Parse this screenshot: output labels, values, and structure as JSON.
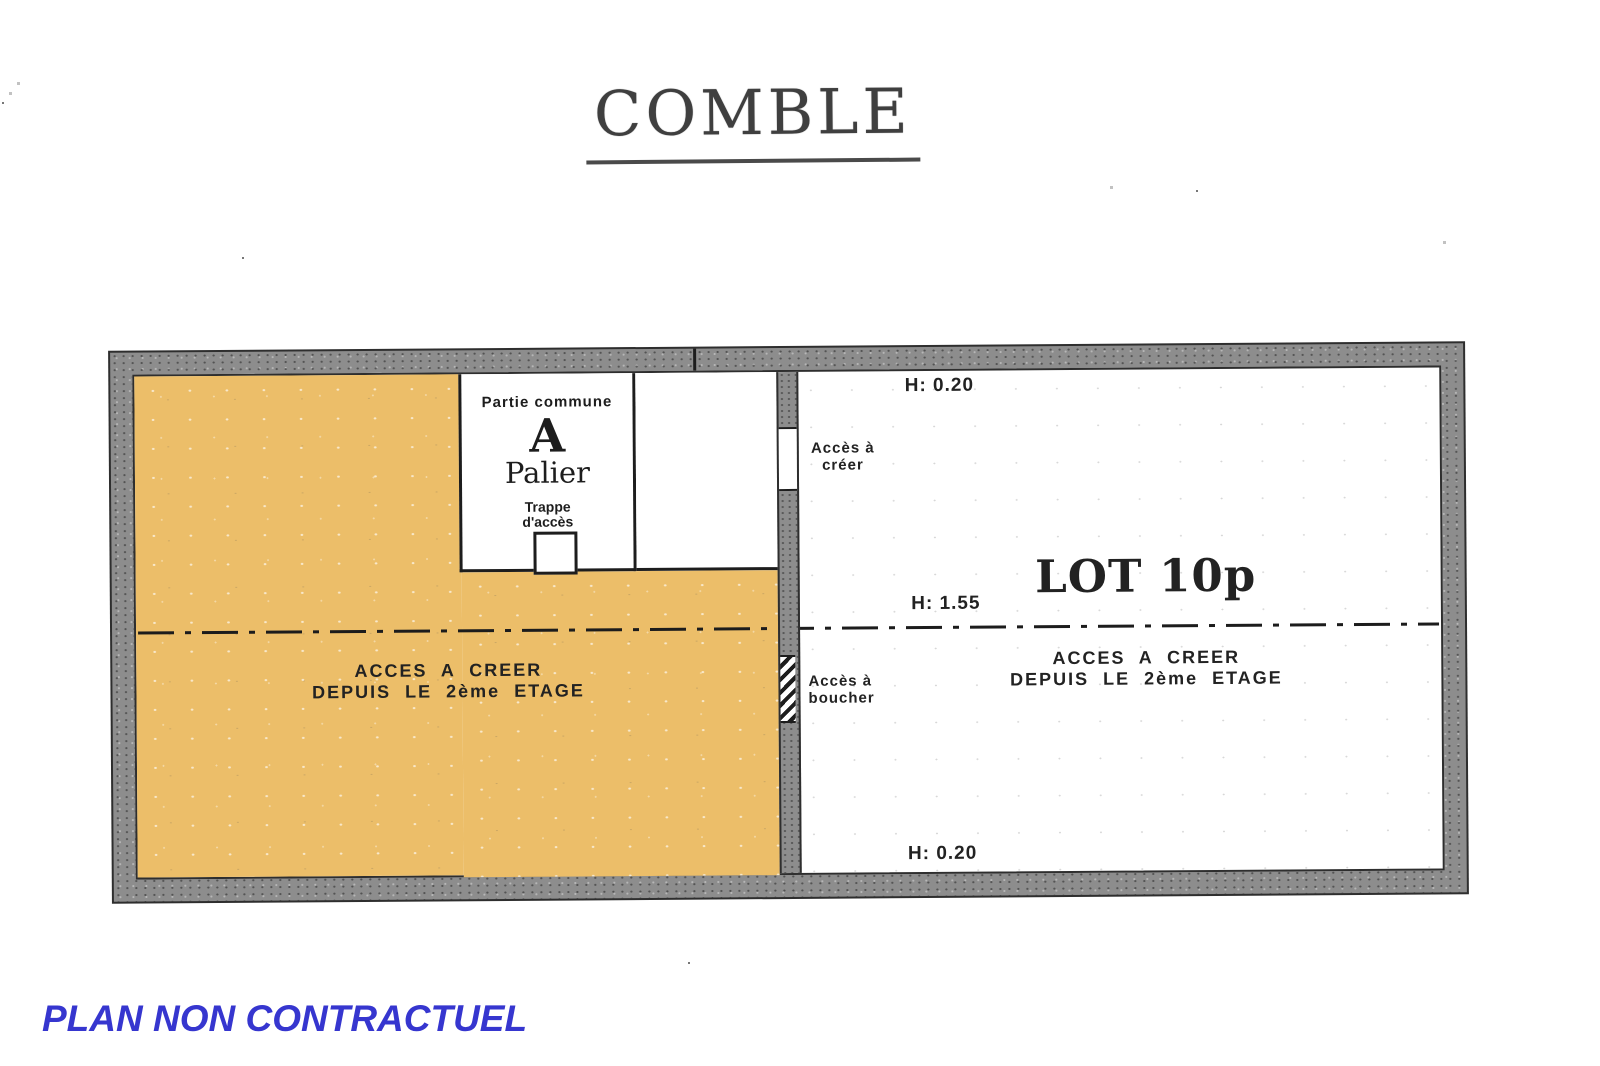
{
  "page": {
    "title": "COMBLE",
    "disclaimer": "PLAN NON CONTRACTUEL"
  },
  "plan": {
    "common_area": {
      "category": "Partie commune",
      "letter": "A",
      "name": "Palier",
      "trap_line1": "Trappe",
      "trap_line2": "d'accès"
    },
    "left_zone": {
      "note_line1": "ACCES A CREER",
      "note_line2": "DEPUIS LE 2ème ETAGE"
    },
    "right_zone": {
      "lot_label": "LOT 10p",
      "note_line1": "ACCES A CREER",
      "note_line2": "DEPUIS LE 2ème ETAGE",
      "height_top": "H: 0.20",
      "height_middle": "H: 1.55",
      "height_bottom": "H: 0.20"
    },
    "openings": {
      "create_line1": "Accès à",
      "create_line2": "créer",
      "block_line1": "Accès à",
      "block_line2": "boucher"
    },
    "colors": {
      "highlight_orange": "#ecbe69",
      "wall_gray": "#8d8d8d",
      "ink": "#1d1d1d",
      "disclaimer_blue": "#3636cf"
    }
  }
}
